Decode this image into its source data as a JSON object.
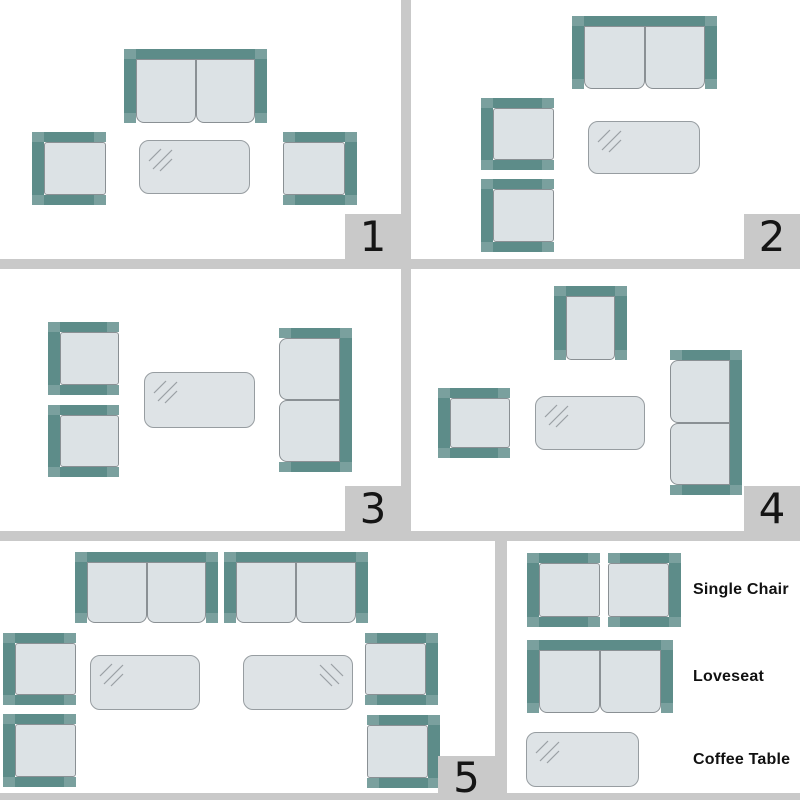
{
  "colors": {
    "background": "#ffffff",
    "teal": "#5d8c89",
    "cushion_fill": "#dce2e5",
    "cushion_border": "#8a9094",
    "table_fill": "#dee3e6",
    "table_border": "#979da1",
    "shine": "#9aa0a4",
    "divider": "#c9c9c9",
    "number_bg": "#c9c9c9",
    "number_color": "#151515",
    "label_color": "#111111"
  },
  "legend": {
    "labels": [
      "Single Chair",
      "Loveseat",
      "Coffee Table"
    ],
    "glyphs": [
      {
        "type": "chair",
        "facing": "right",
        "x": 20,
        "y": 12,
        "w": 73,
        "h": 74
      },
      {
        "type": "chair",
        "facing": "left",
        "x": 101,
        "y": 12,
        "w": 73,
        "h": 74
      },
      {
        "type": "loveseat",
        "facing": "down",
        "x": 20,
        "y": 99,
        "w": 146,
        "h": 73
      },
      {
        "type": "table",
        "x": 19,
        "y": 191,
        "w": 113,
        "h": 55,
        "shine": "tl"
      }
    ]
  },
  "layouts": [
    {
      "number": "1",
      "items": [
        {
          "type": "loveseat",
          "facing": "down",
          "x": 124,
          "y": 49,
          "w": 143,
          "h": 74
        },
        {
          "type": "chair",
          "facing": "right",
          "x": 32,
          "y": 132,
          "w": 74,
          "h": 73
        },
        {
          "type": "table",
          "x": 139,
          "y": 140,
          "w": 111,
          "h": 54,
          "shine": "tl"
        },
        {
          "type": "chair",
          "facing": "left",
          "x": 283,
          "y": 132,
          "w": 74,
          "h": 73
        }
      ]
    },
    {
      "number": "2",
      "items": [
        {
          "type": "loveseat",
          "facing": "down",
          "x": 161,
          "y": 16,
          "w": 145,
          "h": 73
        },
        {
          "type": "chair",
          "facing": "right",
          "x": 70,
          "y": 98,
          "w": 73,
          "h": 72
        },
        {
          "type": "chair",
          "facing": "right",
          "x": 70,
          "y": 179,
          "w": 73,
          "h": 73
        },
        {
          "type": "table",
          "x": 177,
          "y": 121,
          "w": 112,
          "h": 53,
          "shine": "tl"
        }
      ]
    },
    {
      "number": "3",
      "items": [
        {
          "type": "chair",
          "facing": "right",
          "x": 48,
          "y": 53,
          "w": 71,
          "h": 73
        },
        {
          "type": "chair",
          "facing": "right",
          "x": 48,
          "y": 136,
          "w": 71,
          "h": 72
        },
        {
          "type": "table",
          "x": 144,
          "y": 103,
          "w": 111,
          "h": 56,
          "shine": "tl"
        },
        {
          "type": "loveseat",
          "facing": "left",
          "x": 279,
          "y": 59,
          "w": 73,
          "h": 144
        }
      ]
    },
    {
      "number": "4",
      "items": [
        {
          "type": "chair",
          "facing": "down",
          "x": 143,
          "y": 17,
          "w": 73,
          "h": 74
        },
        {
          "type": "chair",
          "facing": "right",
          "x": 27,
          "y": 119,
          "w": 72,
          "h": 70
        },
        {
          "type": "table",
          "x": 124,
          "y": 127,
          "w": 110,
          "h": 54,
          "shine": "tl"
        },
        {
          "type": "loveseat",
          "facing": "left",
          "x": 259,
          "y": 81,
          "w": 72,
          "h": 145
        }
      ]
    },
    {
      "number": "5",
      "items": [
        {
          "type": "loveseat",
          "facing": "down",
          "x": 75,
          "y": 11,
          "w": 143,
          "h": 71
        },
        {
          "type": "loveseat",
          "facing": "down",
          "x": 224,
          "y": 11,
          "w": 144,
          "h": 71
        },
        {
          "type": "chair",
          "facing": "right",
          "x": 3,
          "y": 92,
          "w": 73,
          "h": 72
        },
        {
          "type": "chair",
          "facing": "right",
          "x": 3,
          "y": 173,
          "w": 73,
          "h": 73
        },
        {
          "type": "table",
          "x": 90,
          "y": 114,
          "w": 110,
          "h": 55,
          "shine": "tl"
        },
        {
          "type": "table",
          "x": 243,
          "y": 114,
          "w": 110,
          "h": 55,
          "shine": "tr"
        },
        {
          "type": "chair",
          "facing": "left",
          "x": 365,
          "y": 92,
          "w": 73,
          "h": 72
        },
        {
          "type": "chair",
          "facing": "left",
          "x": 367,
          "y": 174,
          "w": 73,
          "h": 73
        }
      ]
    }
  ]
}
